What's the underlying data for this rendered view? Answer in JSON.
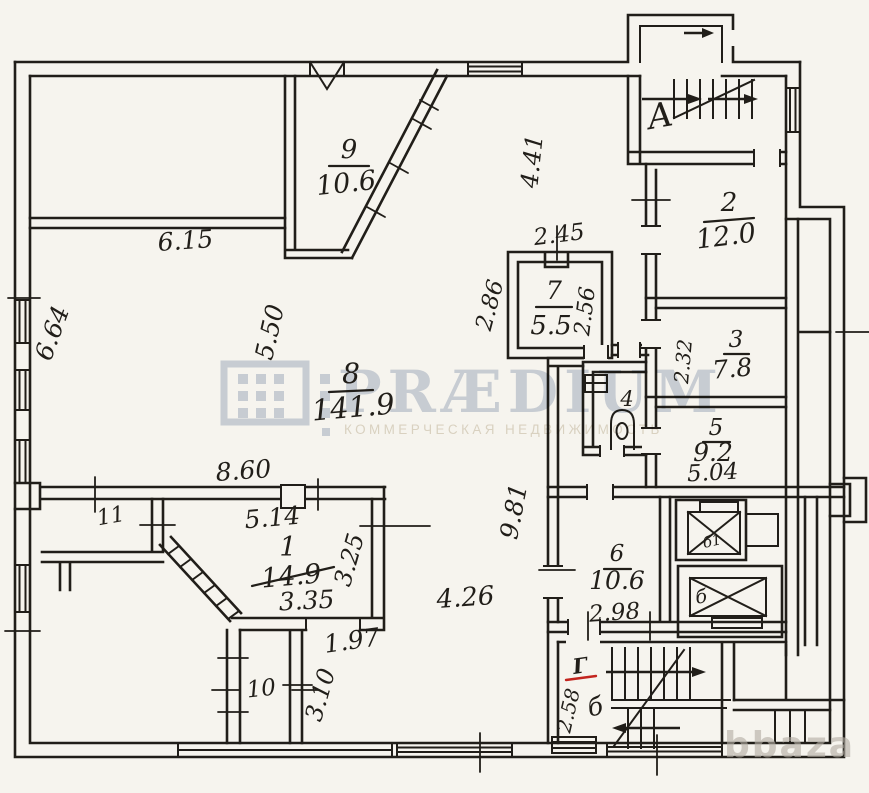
{
  "rooms": {
    "r1": {
      "num": "1",
      "area": "14.9"
    },
    "r2": {
      "num": "2",
      "area": "12.0"
    },
    "r3": {
      "num": "3",
      "area": "7.8"
    },
    "r4": {
      "num": "4"
    },
    "r5": {
      "num": "5",
      "area": "9.2"
    },
    "r6": {
      "num": "6",
      "area": "10.6"
    },
    "r7": {
      "num": "7",
      "area": "5.5"
    },
    "r8": {
      "num": "8",
      "area": "141.9"
    },
    "r9": {
      "num": "9",
      "area": "10.6"
    },
    "r10": {
      "num": "10"
    },
    "r11": {
      "num": "11"
    }
  },
  "stairs": {
    "main": "А",
    "rear": "б",
    "red_mark": "Г"
  },
  "elevators": {
    "small": "б1",
    "large": "б"
  },
  "dims": {
    "w615": "6.15",
    "w664": "6.64",
    "w550": "5.50",
    "w441": "4.41",
    "w245": "2.45",
    "w286": "2.86",
    "w256": "2.56",
    "w232": "2.32",
    "w860": "8.60",
    "w514": "5.14",
    "w325": "3.25",
    "w335": "3.35",
    "w981": "9.81",
    "w426": "4.26",
    "w197": "1.97",
    "w310": "3.10",
    "w298": "2.98",
    "w504": "5.04",
    "w258": "2.58"
  },
  "watermark": {
    "brand": "PRÆDIUM",
    "tagline": "КОММЕРЧЕСКАЯ НЕДВИЖИМОСТЬ",
    "site": "bbaza"
  },
  "colors": {
    "ink": "#211e19",
    "paper": "#f6f4ee",
    "red": "#c3241e",
    "brand": "#c7cfdc",
    "tagline": "#dcd5c6",
    "site": "#b4aea5"
  }
}
